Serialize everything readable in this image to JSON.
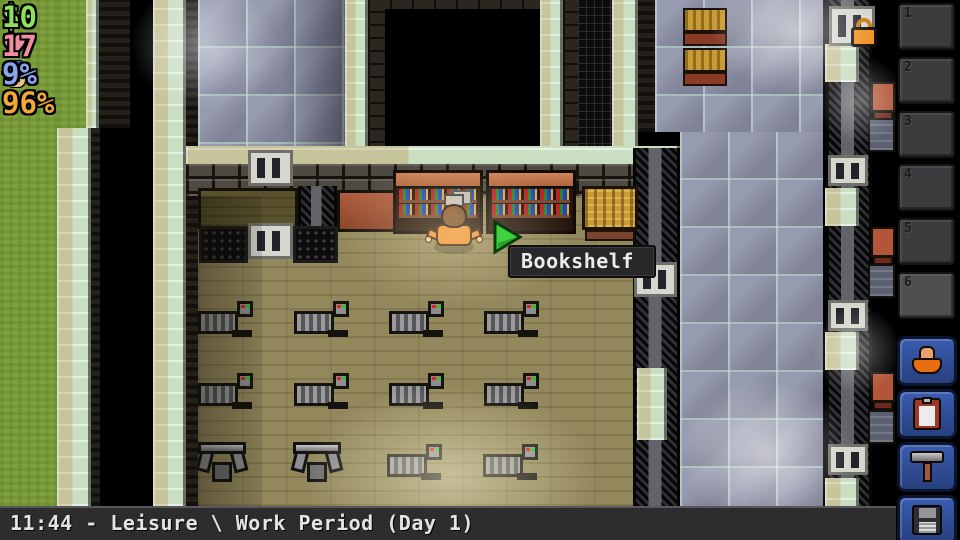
{
  "hud": {
    "money": {
      "prefix": "$",
      "value": "10",
      "color": "#8ce05a"
    },
    "health": {
      "symbol": "♥",
      "value": "17",
      "color": "#f28ca0"
    },
    "guard_heat": {
      "value": "9%",
      "color": "#8ba4f0"
    },
    "energy": {
      "value": "96%",
      "color": "#f2a838"
    }
  },
  "cursor_tooltip": {
    "target": "Bookshelf"
  },
  "status_bar": {
    "text": "11:44 - Leisure \\ Work Period (Day 1)"
  },
  "sidebar": {
    "slots": [
      {
        "number": "1"
      },
      {
        "number": "2"
      },
      {
        "number": "3"
      },
      {
        "number": "4"
      },
      {
        "number": "5"
      },
      {
        "number": "6"
      }
    ],
    "buttons": [
      {
        "name": "prisoner-profile"
      },
      {
        "name": "objectives-clipboard"
      },
      {
        "name": "crafting-hammer"
      },
      {
        "name": "save-game"
      }
    ]
  },
  "colors": {
    "cursor_green": "#3ed43e",
    "button_blue": "#2d4a94",
    "bar_gray": "#2d2d2f"
  },
  "map": {
    "treadmills": [
      {
        "x": 198,
        "y": 300
      },
      {
        "x": 294,
        "y": 300
      },
      {
        "x": 389,
        "y": 300
      },
      {
        "x": 484,
        "y": 300
      },
      {
        "x": 198,
        "y": 372
      },
      {
        "x": 294,
        "y": 372
      },
      {
        "x": 389,
        "y": 372
      },
      {
        "x": 484,
        "y": 372
      },
      {
        "x": 387,
        "y": 443
      },
      {
        "x": 483,
        "y": 443
      }
    ],
    "weight_benches": [
      {
        "x": 196,
        "y": 438
      },
      {
        "x": 291,
        "y": 438
      }
    ],
    "right_cells": {
      "fence_vents_y": [
        155,
        300,
        444
      ],
      "wall_patches_y": [
        44,
        188,
        332,
        478
      ],
      "beds_y": [
        82,
        227,
        372
      ],
      "lockers_y": [
        118,
        264,
        410
      ]
    }
  }
}
